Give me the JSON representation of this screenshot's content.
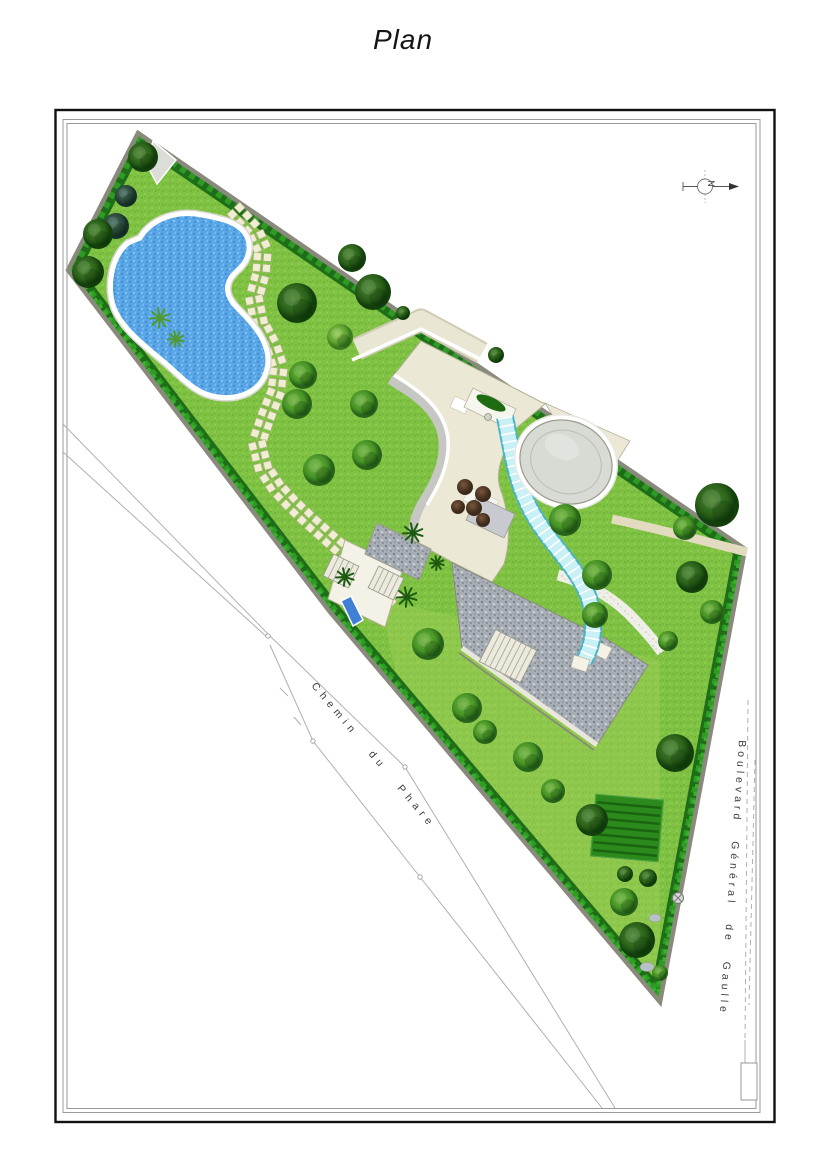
{
  "page": {
    "title": "Plan"
  },
  "compass": {
    "letter": "N"
  },
  "streets": {
    "chemin": "Chemin du Phare",
    "boulevard": "Boulevard Général de Gaulle"
  },
  "palette": {
    "lawn": "#80c344",
    "lawn_light": "#a8d55e",
    "hedge_dark": "#1e6e18",
    "hedge_bright": "#2f9b25",
    "boundary_wall": "#8a8a7c",
    "pool_water": "#5aa7e8",
    "pool_coping": "#ffffff",
    "stepping_stone": "#f1edd3",
    "roof_cream": "#ece8d6",
    "dome_gray": "#d7dbd3",
    "glass_canopy": "#c9f0f5",
    "glass_edge": "#49b4c4",
    "gravel": "#aab0b6",
    "vegetable_garden": "#2c8a1c",
    "road_line": "#b0b0b0",
    "frame_black": "#111111",
    "frame_gray": "#9a9a9a"
  },
  "features": [
    "triangular-parcel",
    "swimming-pool",
    "stepping-stone-path",
    "villa-flat-roof",
    "dome-rotunda",
    "curved-glass-canopy",
    "inner-courtyard",
    "gravel-driveway",
    "outdoor-stairs",
    "spa-bench",
    "pebble-path",
    "vegetable-garden",
    "boundary-hedge",
    "garden-trees",
    "north-arrow"
  ]
}
